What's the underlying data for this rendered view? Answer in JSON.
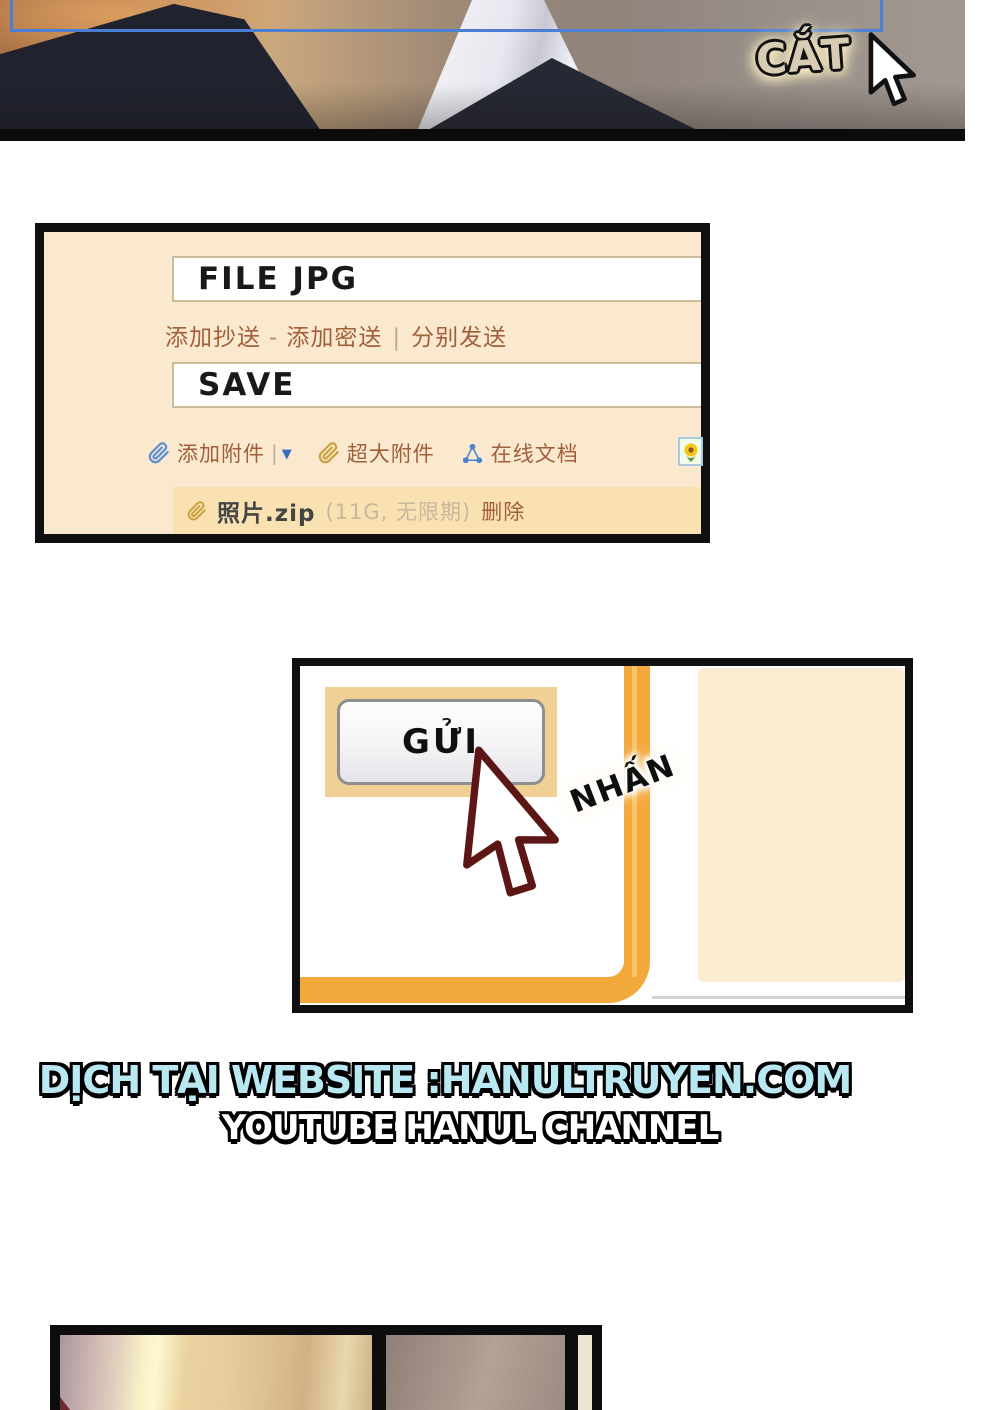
{
  "top_panel": {
    "caption": "CẮT"
  },
  "email_panel": {
    "to_value": "FILE JPG",
    "links": {
      "add_cc": "添加抄送",
      "dash": "-",
      "add_bcc": "添加密送",
      "pipe": "|",
      "send_separately": "分别发送"
    },
    "subject_value": "SAVE",
    "toolbar": {
      "add_attachment": "添加附件",
      "pipe": "|",
      "dropdown": "▼",
      "large_attachment": "超大附件",
      "online_doc": "在线文档"
    },
    "attachment": {
      "filename": "照片.zip",
      "meta": "(11G, 无限期)",
      "delete": "删除"
    }
  },
  "send_panel": {
    "button": "GỬI",
    "caption": "NHẤN"
  },
  "credits": {
    "line1": "DỊCH TẠI WEBSITE :HANULTRUYEN.COM",
    "line2": "YOUTUBE HANUL CHANNEL"
  },
  "colors": {
    "link_brown": "#a0603a",
    "accent_orange": "#f3a83c",
    "panel_cream": "#fbe9cf",
    "attachment_row_bg": "#fae1b1",
    "selection_blue": "#4a7fd4",
    "credit_blue": "#b9e7f2"
  }
}
